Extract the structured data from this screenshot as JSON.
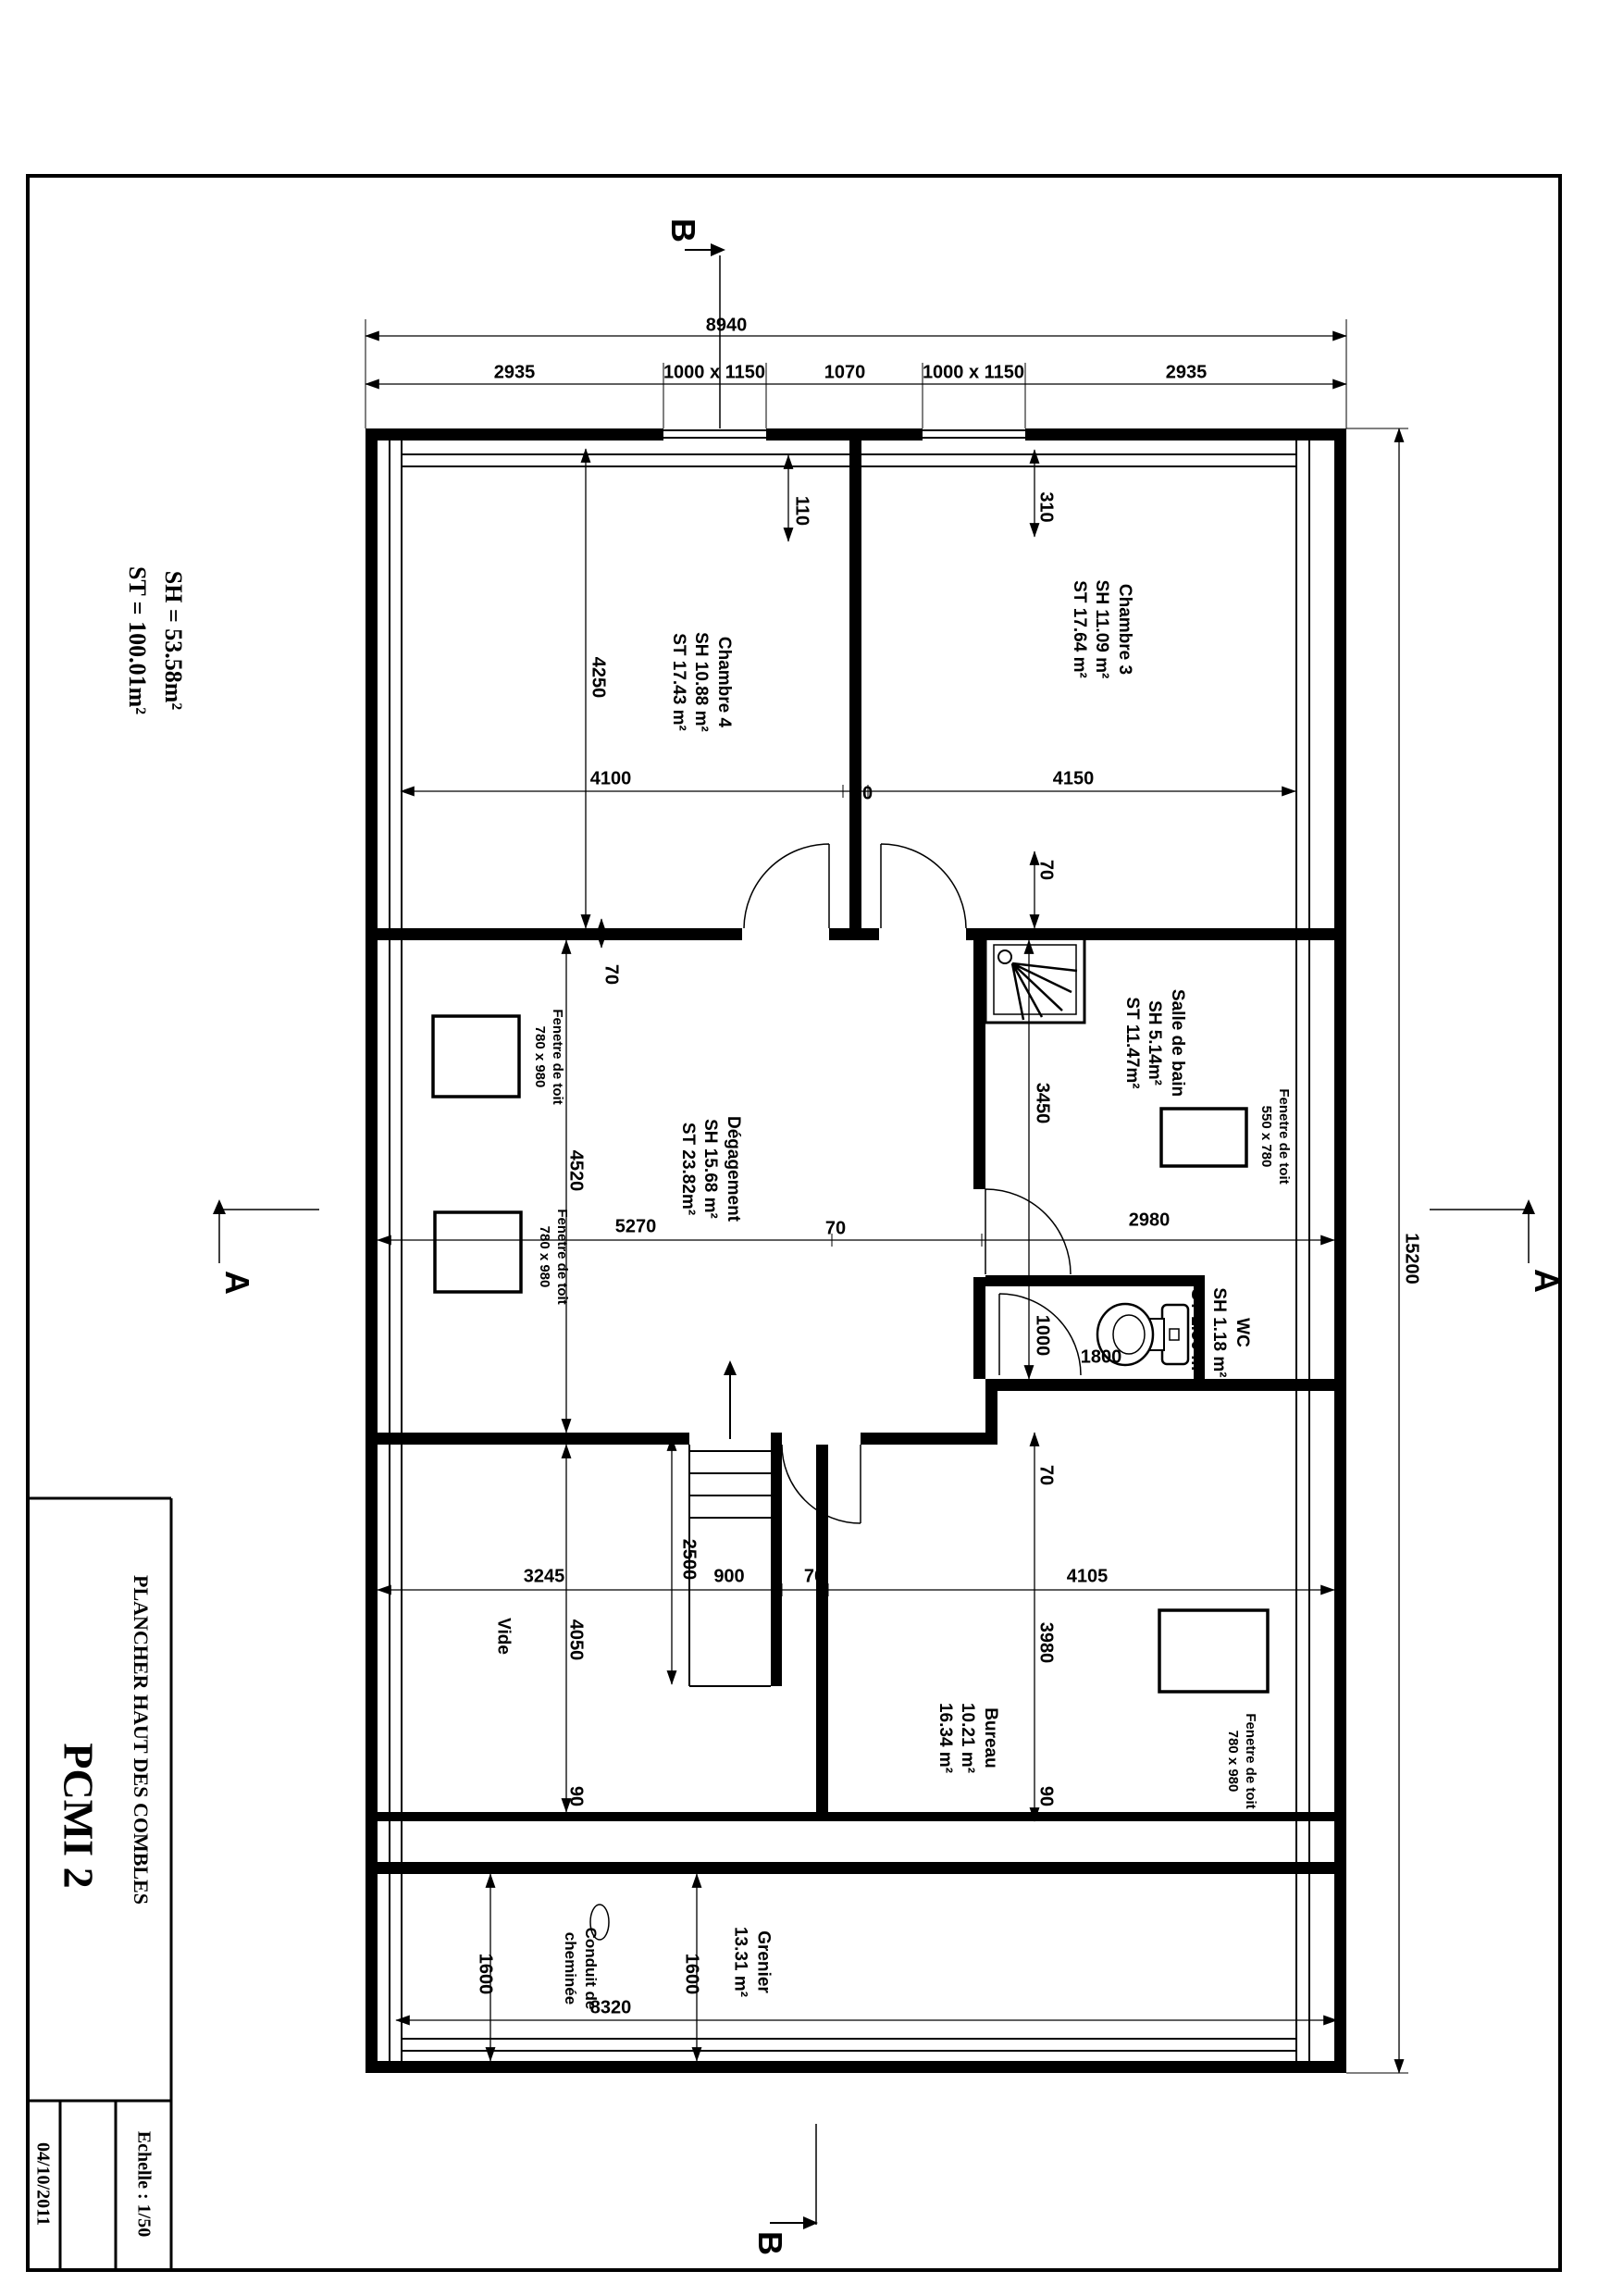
{
  "page": {
    "title": "PCMI 2",
    "subtitle": "PLANCHER HAUT DES COMBLES",
    "date": "04/10/2011",
    "scale": "Echelle : 1/50",
    "sh_total": "SH = 53.58m²",
    "st_total": "ST = 100.01m²"
  },
  "rooms": {
    "chambre3": {
      "name": "Chambre 3",
      "sh": "SH 11.09 m²",
      "st": "ST 17.64 m²"
    },
    "chambre4": {
      "name": "Chambre 4",
      "sh": "SH 10.88 m²",
      "st": "ST 17.43 m²"
    },
    "degagement": {
      "name": "Dégagement",
      "sh": "SH 15.68 m²",
      "st": "ST 23.82m²"
    },
    "salle_de_bain": {
      "name": "Salle de bain",
      "sh": "SH 5.14m²",
      "st": "ST 11.47m²"
    },
    "wc": {
      "name": "WC",
      "sh": "SH 1.18 m²",
      "st": "ST 1.50 m²"
    },
    "bureau": {
      "name": "Bureau",
      "sh": "10.21 m²",
      "st": "16.34 m²"
    },
    "grenier": {
      "name": "Grenier",
      "sh": "13.31 m²"
    },
    "vide": {
      "name": "Vide"
    }
  },
  "features": {
    "roof_window_780": {
      "label": "Fenetre de toit",
      "size": "780 x 980"
    },
    "roof_window_550": {
      "label": "Fenetre de toit",
      "size": "550 x 780"
    },
    "chimney": {
      "line1": "Conduit de",
      "line2": "cheminée"
    }
  },
  "sections": {
    "a": "A",
    "b": "B"
  },
  "dims": {
    "d8940": "8940",
    "d2935": "2935",
    "dwin": "1000 x 1150",
    "d1070": "1070",
    "d110": "110",
    "d310": "310",
    "d4250": "4250",
    "d4100": "4100",
    "d70": "70",
    "d4150": "4150",
    "d15200": "15200",
    "d4520": "4520",
    "d5270": "5270",
    "d2980": "2980",
    "d3450": "3450",
    "d1000": "1000",
    "d1800": "1800",
    "d2500": "2500",
    "d3245": "3245",
    "d900": "900",
    "d4105": "4105",
    "d4050": "4050",
    "d3980": "3980",
    "d90": "90",
    "d1600": "1600",
    "d8320": "8320"
  }
}
